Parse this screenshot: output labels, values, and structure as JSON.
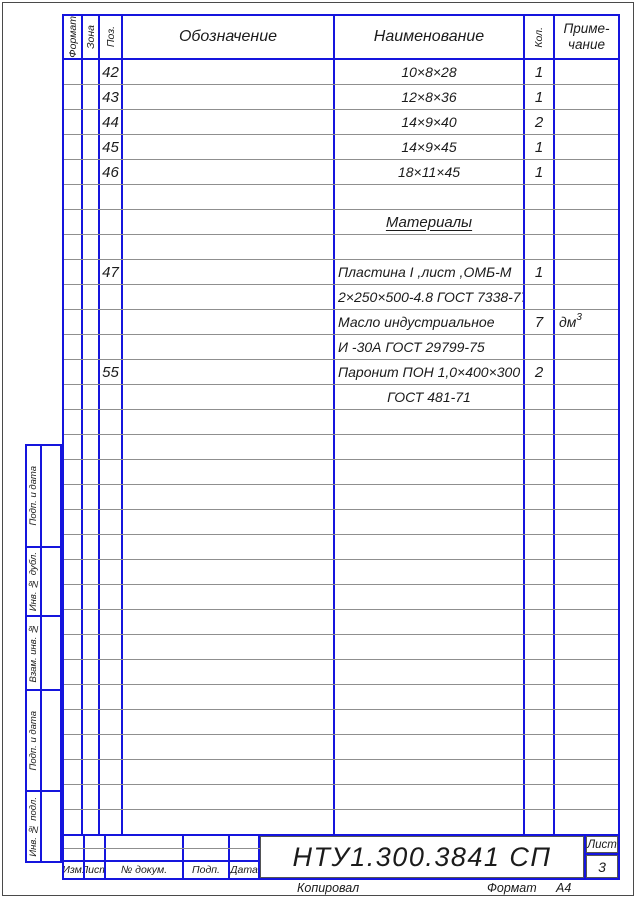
{
  "colors": {
    "frame_blue": "#1515dd",
    "row_separator": "#8f8f8f",
    "text": "#1b1b1b"
  },
  "header": {
    "format": "Формат",
    "zone": "Зона",
    "position": "Поз.",
    "designation": "Обозначение",
    "name": "Наименование",
    "qty": "Кол.",
    "note_line1": "Приме-",
    "note_line2": "чание"
  },
  "rows": [
    {
      "pos": "42",
      "name": "10×8×28",
      "qty": "1"
    },
    {
      "pos": "43",
      "name": "12×8×36",
      "qty": "1"
    },
    {
      "pos": "44",
      "name": "14×9×40",
      "qty": "2"
    },
    {
      "pos": "45",
      "name": "14×9×45",
      "qty": "1"
    },
    {
      "pos": "46",
      "name": "18×11×45",
      "qty": "1"
    },
    {},
    {
      "name": "Материалы",
      "name_style": "underline"
    },
    {},
    {
      "pos": "47",
      "name": "Пластина I ,лист ,ОМБ-М",
      "qty": "1",
      "name_align": "left"
    },
    {
      "name": "2×250×500-4.8 ГОСТ 7338-77",
      "name_align": "left"
    },
    {
      "name": "Масло индустриальное",
      "qty": "7",
      "note": "дм",
      "note_sup": "3",
      "name_align": "left"
    },
    {
      "name": "И -30А ГОСТ 29799-75",
      "name_align": "left"
    },
    {
      "pos": "55",
      "name": "Паронит ПОН 1,0×400×300",
      "qty": "2",
      "name_align": "left"
    },
    {
      "name": "ГОСТ 481-71"
    },
    {},
    {},
    {},
    {},
    {},
    {},
    {},
    {},
    {},
    {},
    {},
    {},
    {},
    {},
    {},
    {},
    {}
  ],
  "sidebar": {
    "items": [
      {
        "label": "Подп. и дата"
      },
      {
        "label": "Инв. № дубл."
      },
      {
        "label": "Взам. инв. №"
      },
      {
        "label": "Подп. и дата"
      },
      {
        "label": "Инв. № подл."
      }
    ]
  },
  "title_block": {
    "labels": [
      "Изм.",
      "Лист",
      "№ докум.",
      "Подп.",
      "Дата"
    ],
    "doc_number": "НТУ1.300.3841 СП",
    "sheet_label": "Лист",
    "sheet_number": "3"
  },
  "footer": {
    "copied_by": "Копировал",
    "format_label": "Формат",
    "format_value": "А4"
  }
}
